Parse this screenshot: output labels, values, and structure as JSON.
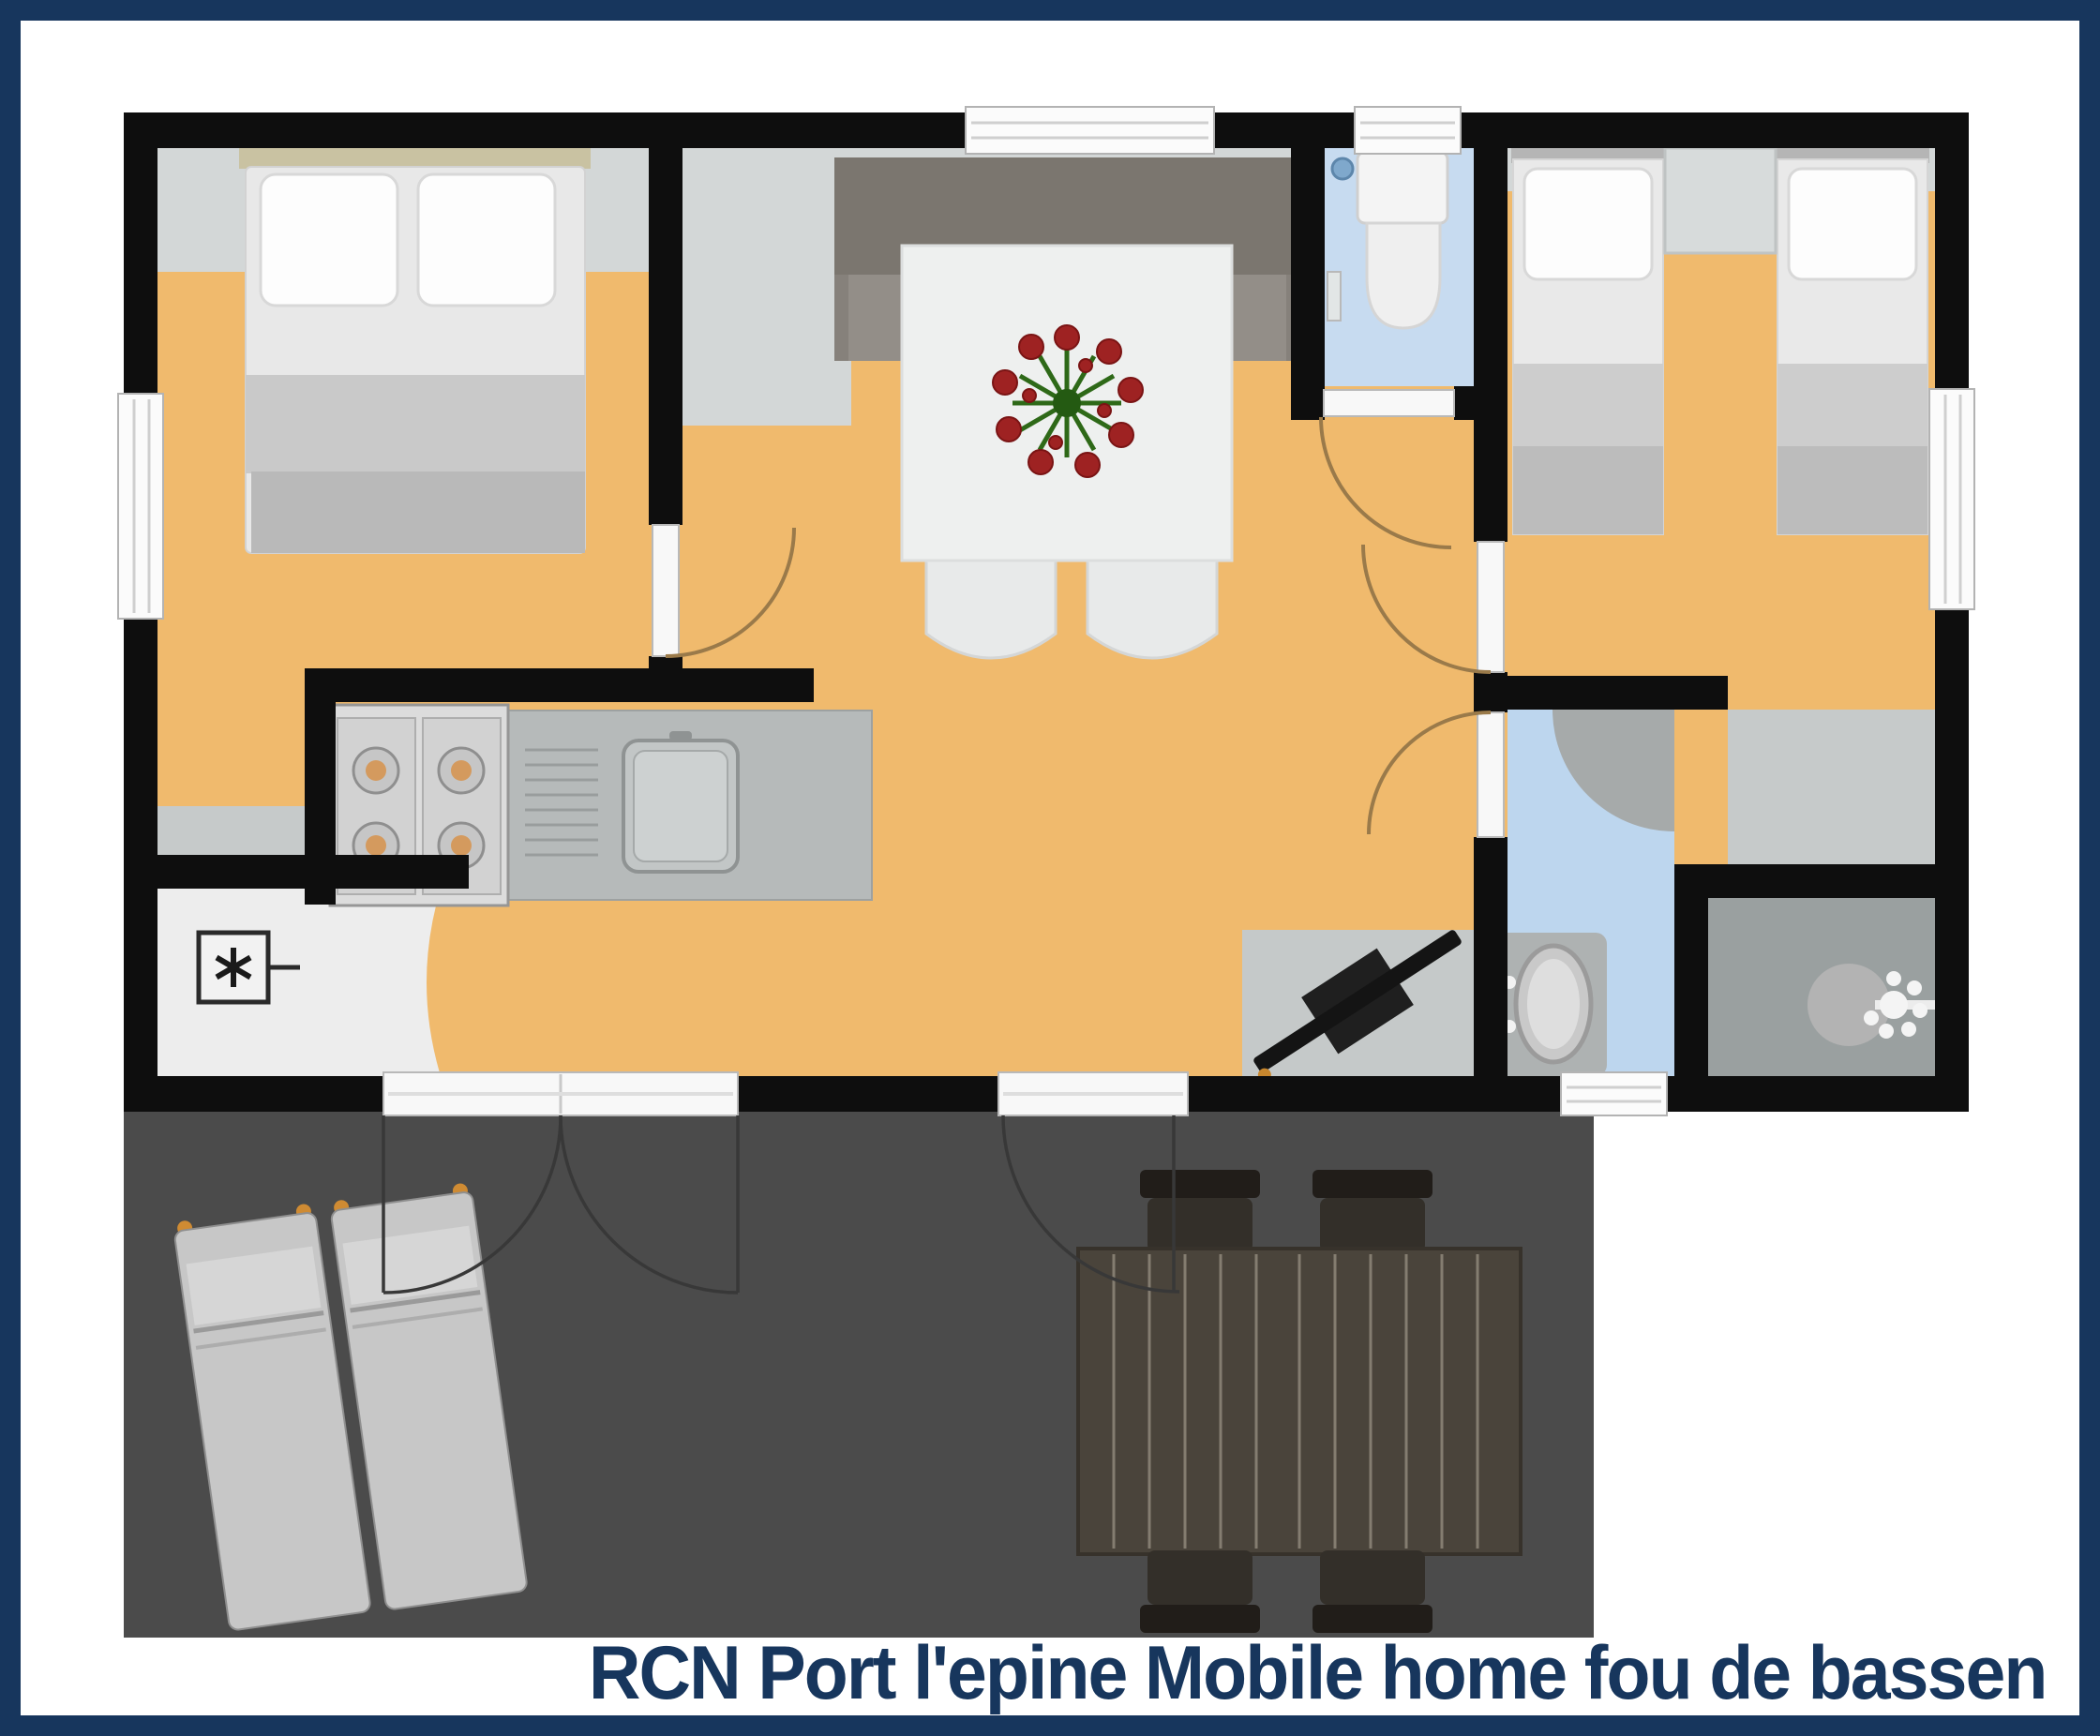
{
  "caption": "RCN Port l'epine Mobile home fou de bassen",
  "colors": {
    "frame-navy": "#17365d",
    "caption-navy": "#17365d",
    "wall-black": "#0e0e0e",
    "floor-orange": "#f0ba6d",
    "floor-gray": "#d3d7d7",
    "floor-gray-dark": "#c6caca",
    "floor-blue": "#c7dbf0",
    "floor-blue-bath": "#bdd6ee",
    "floor-shower": "#9aa0a0",
    "floor-storage": "#ededed",
    "terrace-gray": "#4b4b4b",
    "counter-gray": "#b6baba",
    "door-arc": "#9a7a4a",
    "window-white": "#fbfbfb"
  },
  "floorplan": {
    "type": "mobile-home top-view floor plan",
    "rooms": [
      {
        "id": "double-bedroom",
        "floor": "floor-orange",
        "furniture": [
          "double-bed"
        ]
      },
      {
        "id": "living-dining",
        "floor": "floor-orange",
        "furniture": [
          "sideboard",
          "dining-table",
          "flower-centerpiece",
          "2 chairs",
          "flatscreen-tv"
        ]
      },
      {
        "id": "kitchen",
        "floor": "floor-orange",
        "furniture": [
          "4-burner-stove",
          "counter",
          "drainboard",
          "sink"
        ]
      },
      {
        "id": "storage",
        "floor": "floor-storage",
        "furniture": [
          "fridge-symbol"
        ]
      },
      {
        "id": "wc",
        "floor": "floor-blue",
        "furniture": [
          "toilet"
        ]
      },
      {
        "id": "twin-bedroom",
        "floor": "floor-orange",
        "furniture": [
          "single-bed",
          "single-bed",
          "nightstand"
        ]
      },
      {
        "id": "bathroom",
        "floor": "floor-blue-bath",
        "furniture": [
          "wash-basin"
        ]
      },
      {
        "id": "shower",
        "floor": "floor-shower",
        "furniture": [
          "shower-head"
        ]
      },
      {
        "id": "terrace",
        "floor": "terrace-gray",
        "furniture": [
          "2 sun-loungers",
          "picnic-table",
          "4 terrace-chairs"
        ]
      }
    ],
    "openings": [
      "left-window",
      "top-living-window",
      "top-wc-window",
      "right-bedroom-window",
      "bathroom-window",
      "french-double-door-to-terrace",
      "terrace-door",
      "5 interior doors with swing arcs"
    ]
  }
}
